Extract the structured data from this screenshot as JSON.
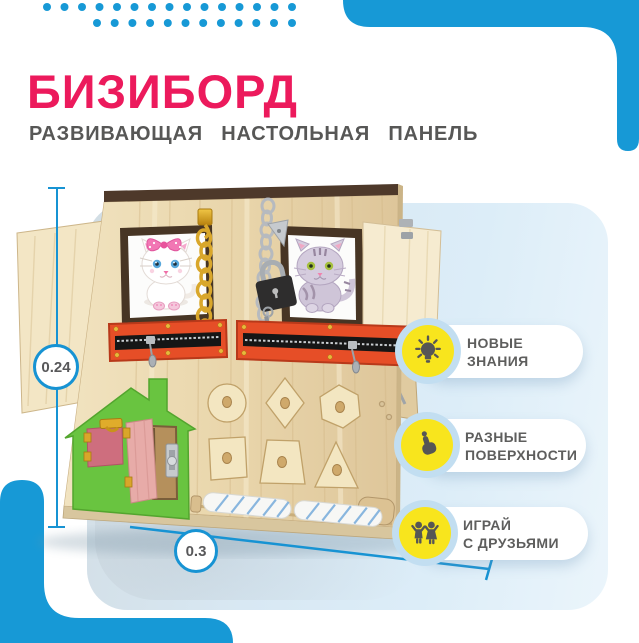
{
  "page": {
    "title": "БИЗИБОРД",
    "subtitle": "РАЗВИВАЮЩАЯ НАСТОЛЬНАЯ ПАНЕЛЬ"
  },
  "dimensions": {
    "height_label": "0.24",
    "width_label": "0.3"
  },
  "features": [
    {
      "icon": "lightbulb-icon",
      "line1": "НОВЫЕ",
      "line2": "ЗНАНИЯ"
    },
    {
      "icon": "touch-icon",
      "line1": "РАЗНЫЕ",
      "line2": "ПОВЕРХНОСТИ"
    },
    {
      "icon": "children-icon",
      "line1": "ИГРАЙ",
      "line2": "С ДРУЗЬЯМИ"
    }
  ],
  "colors": {
    "accent_blue": "#1799D6",
    "title_pink": "#EC1A5C",
    "text_gray": "#575756",
    "panel_blue": "#D9E9F4",
    "icon_yellow": "#F8E51D",
    "zipper_orange": "#E64E27",
    "house_green": "#69C440"
  }
}
